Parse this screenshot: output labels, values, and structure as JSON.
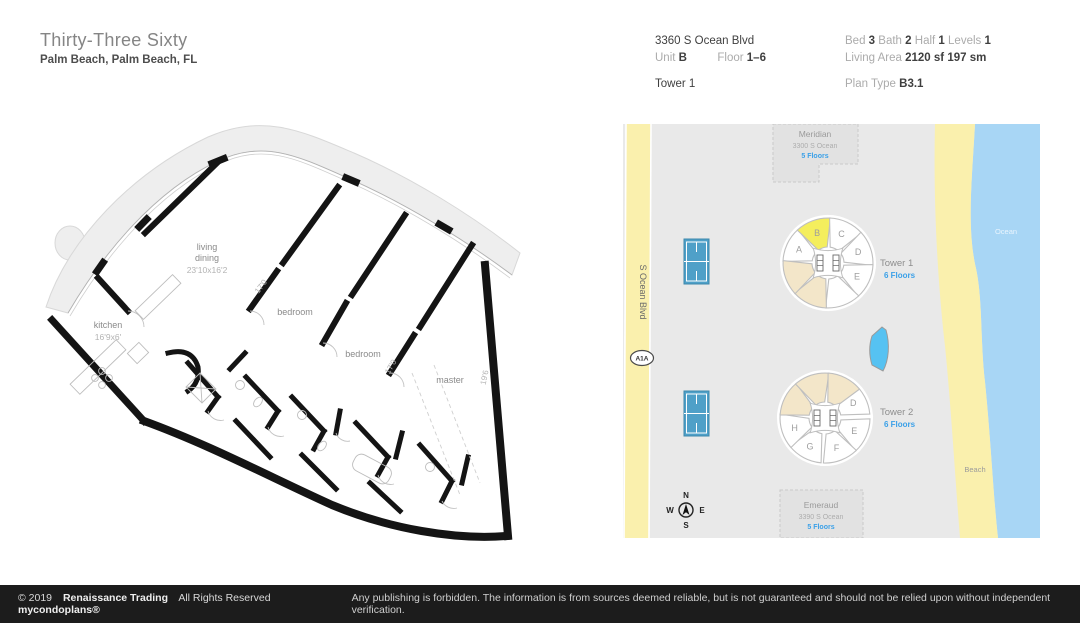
{
  "header": {
    "title": "Thirty-Three Sixty",
    "location": "Palm Beach, Palm Beach, FL",
    "address": "3360 S Ocean Blvd",
    "unit_label": "Unit",
    "unit_value": "B",
    "floor_label": "Floor",
    "floor_value": "1–6",
    "tower": "Tower 1",
    "bed_label": "Bed",
    "bed_value": "3",
    "bath_label": "Bath",
    "bath_value": "2",
    "half_label": "Half",
    "half_value": "1",
    "levels_label": "Levels",
    "levels_value": "1",
    "living_area_label": "Living Area",
    "living_area_sf": "2120 sf",
    "living_area_sm": "197 sm",
    "plan_type_label": "Plan Type",
    "plan_type_value": "B3.1"
  },
  "floorplan": {
    "kitchen_label": "kitchen",
    "kitchen_dims": "16'9x6'",
    "living_label1": "living",
    "living_label2": "dining",
    "living_dims": "23'10x16'2",
    "bedroom1_label": "bedroom",
    "bedroom1_dim": "17'0",
    "bedroom2_label": "bedroom",
    "bedroom2_dim": "17'0",
    "master_label": "master",
    "master_dim": "19'6"
  },
  "map": {
    "road_name": "S Ocean Blvd",
    "road_shield": "A1A",
    "ocean_label": "Ocean",
    "beach_label": "Beach",
    "compass": {
      "n": "N",
      "w": "W",
      "e": "E",
      "s": "S"
    },
    "buildings": [
      {
        "name": "Meridian",
        "address": "3300 S Ocean",
        "floors": "5 Floors"
      },
      {
        "name": "Emeraud",
        "address": "3390 S Ocean",
        "floors": "5 Floors"
      }
    ],
    "unit_colors": {
      "white": "#ffffff",
      "beige": "#f3e6c9",
      "yellow": "#f4ee5d"
    },
    "accent_blue": "#3aa0e8",
    "towers": [
      {
        "name": "Tower 1",
        "floors": "6 Floors",
        "cx": 205,
        "cy": 139,
        "label_x": 257,
        "label_y": 142,
        "units": [
          {
            "letter": "A",
            "angle": 205,
            "fill": "white"
          },
          {
            "letter": "B",
            "angle": 250,
            "fill": "yellow"
          },
          {
            "letter": "C",
            "angle": 295,
            "fill": "white"
          },
          {
            "letter": "D",
            "angle": 340,
            "fill": "white"
          },
          {
            "letter": "E",
            "angle": 25,
            "fill": "white"
          },
          {
            "letter": "",
            "angle": 70,
            "fill": "white"
          },
          {
            "letter": "",
            "angle": 115,
            "fill": "beige"
          },
          {
            "letter": "",
            "angle": 160,
            "fill": "beige"
          }
        ]
      },
      {
        "name": "Tower 2",
        "floors": "6 Floors",
        "cx": 202,
        "cy": 294,
        "label_x": 257,
        "label_y": 291,
        "units": [
          {
            "letter": "D",
            "angle": 332,
            "fill": "white"
          },
          {
            "letter": "E",
            "angle": 24,
            "fill": "white"
          },
          {
            "letter": "F",
            "angle": 69,
            "fill": "white"
          },
          {
            "letter": "G",
            "angle": 118,
            "fill": "white"
          },
          {
            "letter": "H",
            "angle": 162,
            "fill": "white"
          },
          {
            "letter": "",
            "angle": 207,
            "fill": "beige"
          },
          {
            "letter": "",
            "angle": 252,
            "fill": "beige"
          },
          {
            "letter": "",
            "angle": 297,
            "fill": "beige"
          }
        ]
      }
    ]
  },
  "footer": {
    "copyright": "© 2019",
    "company": "Renaissance Trading",
    "rights": "All Rights Reserved",
    "brand": "mycondoplans®",
    "disclaimer": "Any publishing is forbidden.  The information is from sources deemed reliable, but is not guaranteed and should not be relied upon without independent verification."
  }
}
